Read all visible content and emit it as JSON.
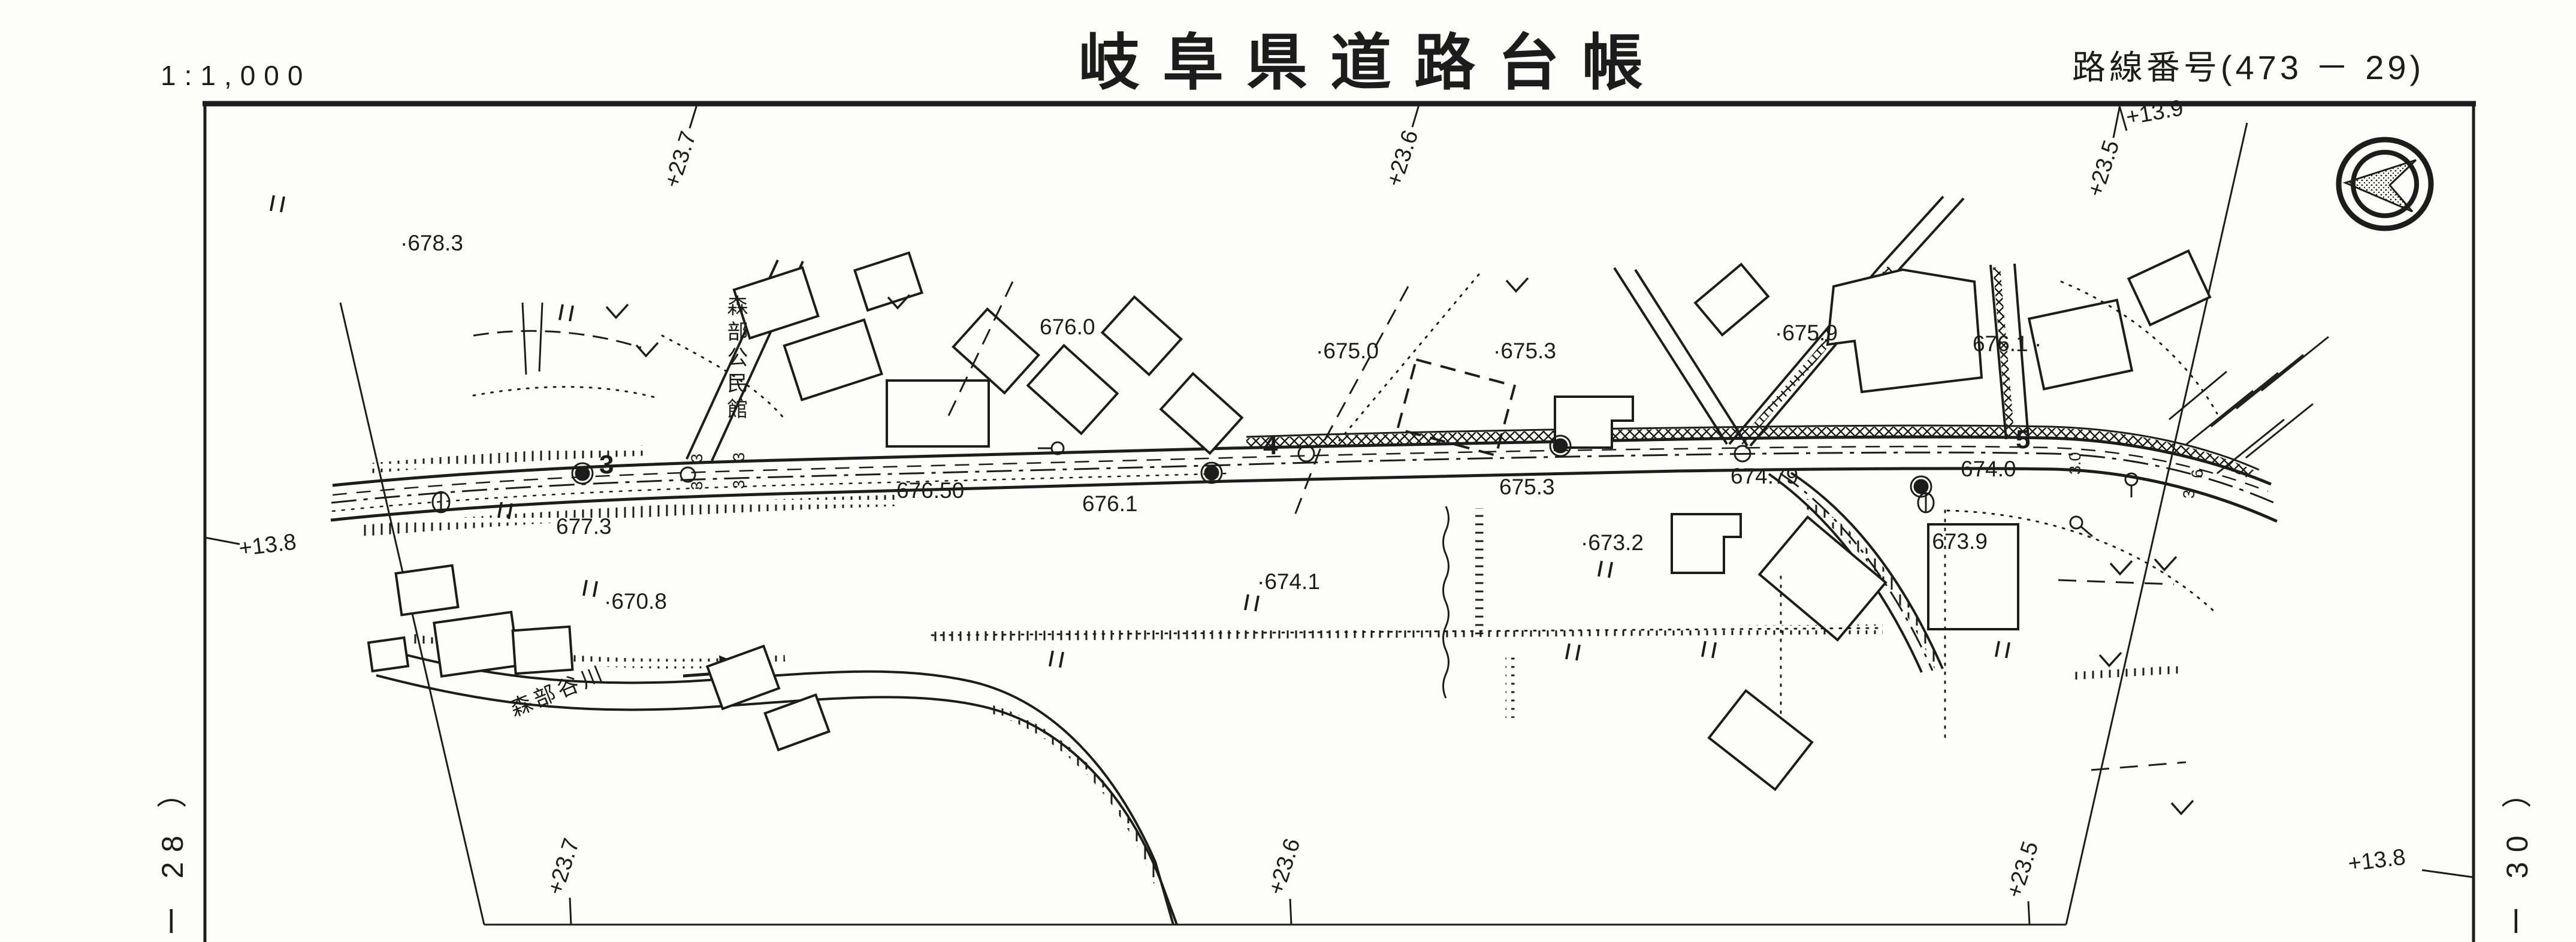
{
  "header": {
    "scale_label": "1:1,000",
    "title": "岐阜県道路台帳",
    "route_label": "路線番号(473 － 29)"
  },
  "edge_labels": {
    "left_sheet": "ー 28 ）",
    "right_sheet": "ー 30 ）"
  },
  "grid_labels": {
    "top_1": "+23.7",
    "top_2": "+23.6",
    "top_3": "+23.5",
    "top_right": "+13.9",
    "left": "+13.8",
    "bottom_1": "+23.7",
    "bottom_2": "+23.6",
    "bottom_3": "+23.5",
    "bottom_right": "+13.8"
  },
  "map": {
    "place_names": {
      "community_center": "森部公民館",
      "river": "森部谷川"
    },
    "stations": {
      "s3": "3",
      "s4": "4",
      "s5": "5"
    },
    "road_elevations": {
      "e1": "676.50",
      "e2": "676.1",
      "e3": "675.3",
      "e4": "674.79",
      "e5": "674.0"
    },
    "spot_elevations": {
      "p1": "·678.3",
      "p2": "676.0",
      "p3": "·675.0",
      "p4": "·675.3",
      "p5": "·675.9",
      "p6": "676.1 ·",
      "p7": "677.3",
      "p8": "·670.8",
      "p9": "·674.1",
      "p10": "·673.2",
      "p11": "·673.9"
    },
    "width_marks": {
      "w1": "3",
      "w2": "3",
      "w3": "3",
      "w4": "3",
      "w5": "3.0",
      "w6": "6",
      "w7": "3"
    }
  },
  "colors": {
    "ink": "#1c1c1c",
    "paper": "#fdfdfb"
  }
}
